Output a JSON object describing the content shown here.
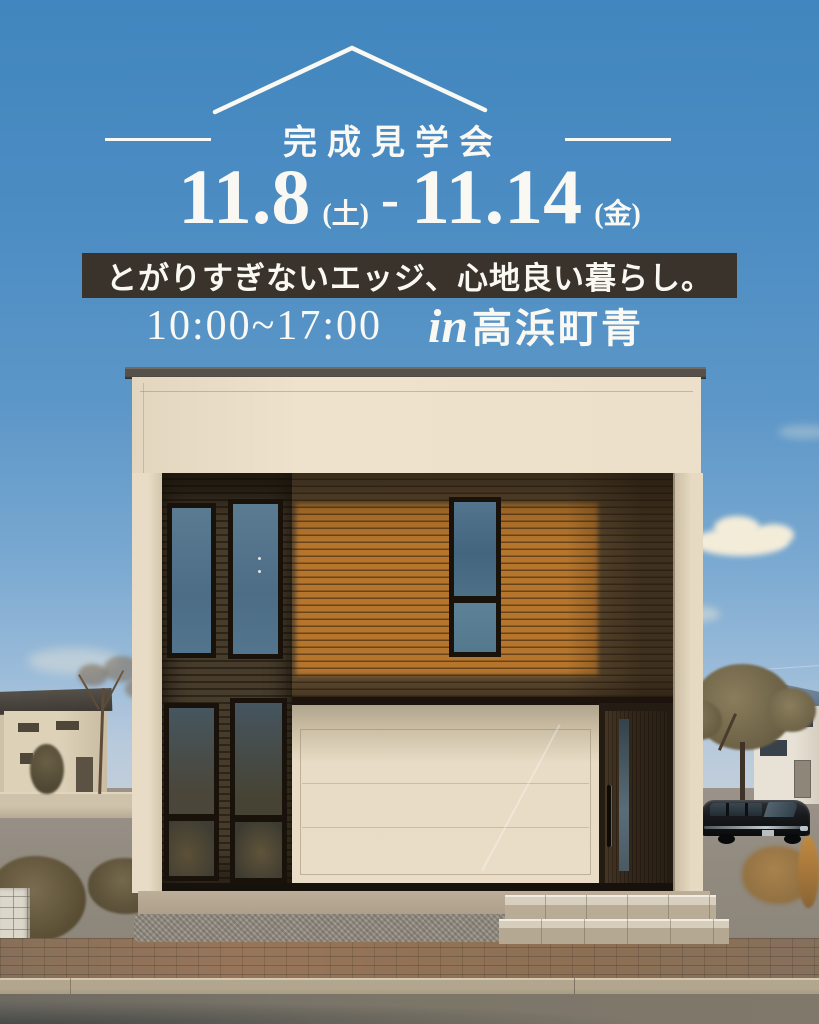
{
  "header": {
    "title": "完成見学会",
    "date_range": {
      "start": "11.8",
      "start_day": "(土)",
      "separator": "-",
      "end": "11.14",
      "end_day": "(金)"
    },
    "tagline": "とがりすぎないエッジ、心地良い暮らし。",
    "hours": "10:00~17:00",
    "location_prefix": "in",
    "location_name": "高浜町青"
  },
  "colors": {
    "sky_top": "#4186be",
    "sky_horizon": "#c3cfda",
    "text_white": "#faf8f2",
    "banner_bg": "#3a332b",
    "wood_sunlit": "#b5752c",
    "wood_shadow": "#5e4a30",
    "dark_siding": "#3c3222",
    "cream_wall": "#ece0ca",
    "glass_blue": "#52748c",
    "door_brown": "#33271a",
    "sidewalk_brick": "#8d7054",
    "road_asphalt": "#7b7569"
  }
}
